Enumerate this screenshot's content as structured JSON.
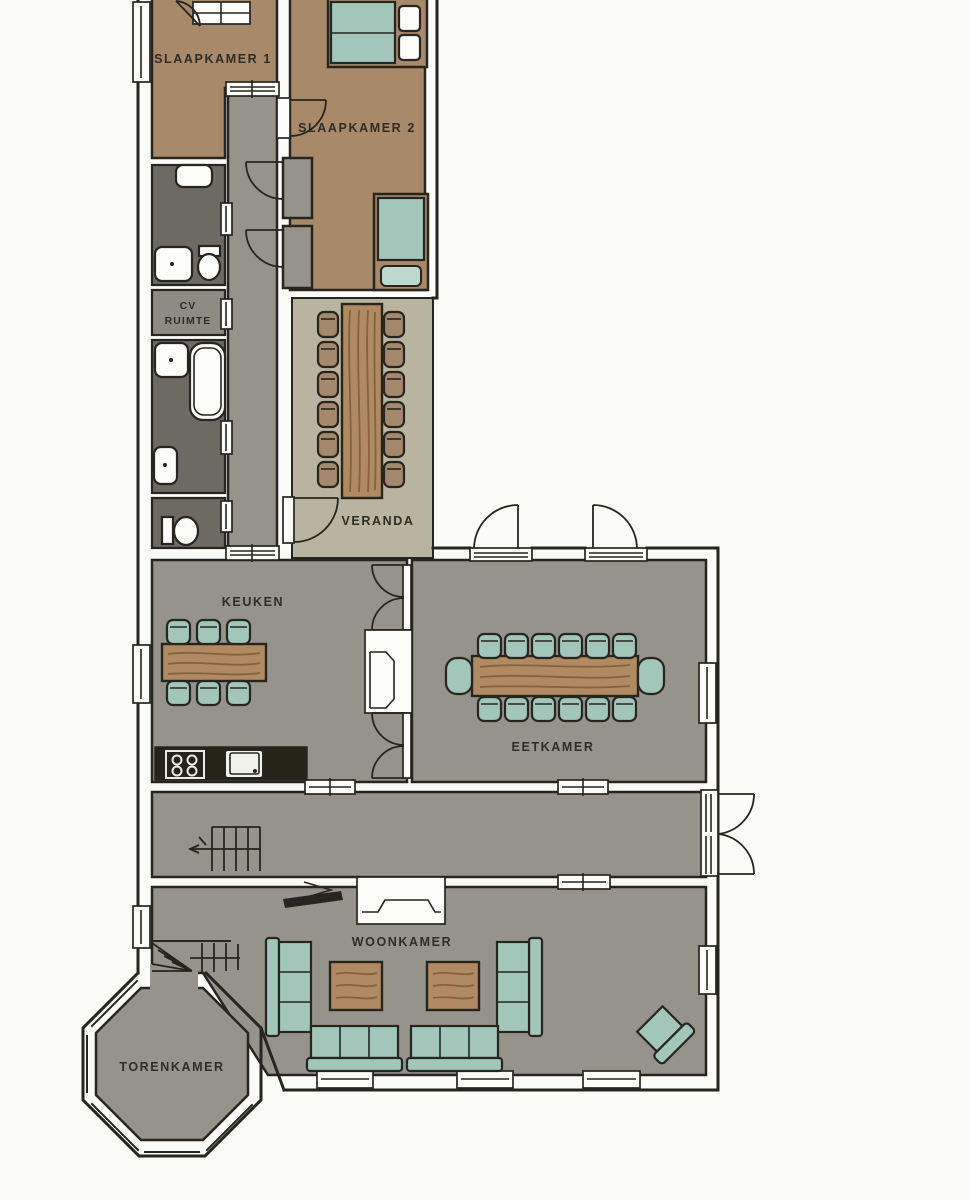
{
  "rooms": {
    "slaapkamer1": {
      "label": "SLAAPKAMER 1"
    },
    "slaapkamer2": {
      "label": "SLAAPKAMER 2"
    },
    "cv_ruimte": {
      "label_line1": "CV",
      "label_line2": "RUIMTE"
    },
    "veranda": {
      "label": "VERANDA"
    },
    "keuken": {
      "label": "KEUKEN"
    },
    "eetkamer": {
      "label": "EETKAMER"
    },
    "woonkamer": {
      "label": "WOONKAMER"
    },
    "torenkamer": {
      "label": "TORENKAMER"
    }
  },
  "colors": {
    "page_bg": "#fbfbf8",
    "wall": "#26251f",
    "floor_gray": "#96948a",
    "floor_brown": "#a8896a",
    "floor_dark": "#6c6a61",
    "floor_cv": "#8e8c82",
    "floor_olive": "#b8b4a0",
    "teal": "#a3c6ba",
    "teal_light": "#bdd8cd",
    "vchair": "#a5896c",
    "wood": "#b08a63",
    "wood_grain": "#7d5a3a",
    "counter": "#262419",
    "fixture": "#fcfcf9",
    "label": "#2e2d27"
  }
}
